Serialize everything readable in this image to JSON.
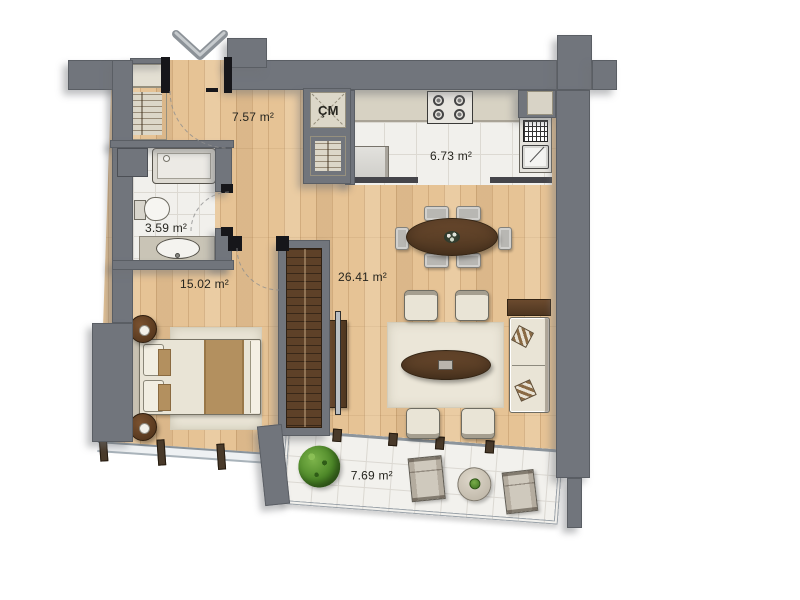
{
  "plan": {
    "rooms": {
      "entry_hall": {
        "area": "7.57 m²"
      },
      "kitchen": {
        "area": "6.73 m²"
      },
      "bathroom": {
        "area": "3.59 m²"
      },
      "bedroom": {
        "area": "15.02 m²"
      },
      "living_room": {
        "area": "26.41 m²"
      },
      "balcony": {
        "area": "7.69 m²"
      },
      "laundry_closet": {
        "label": "ÇM"
      }
    },
    "icons": {
      "entrance_arrow": "chevron-down"
    },
    "colors": {
      "wall": "#71757c",
      "wood_floor": "#e6c395",
      "tile_floor": "#f1f0ec",
      "counter": "#d7d2c3",
      "dark_wood": "#5e4128",
      "cream": "#e9e4d6",
      "chair_gray": "#b8b7b3",
      "accent_textile": "#b3905f",
      "plant_green": "#4f8f2c"
    }
  }
}
